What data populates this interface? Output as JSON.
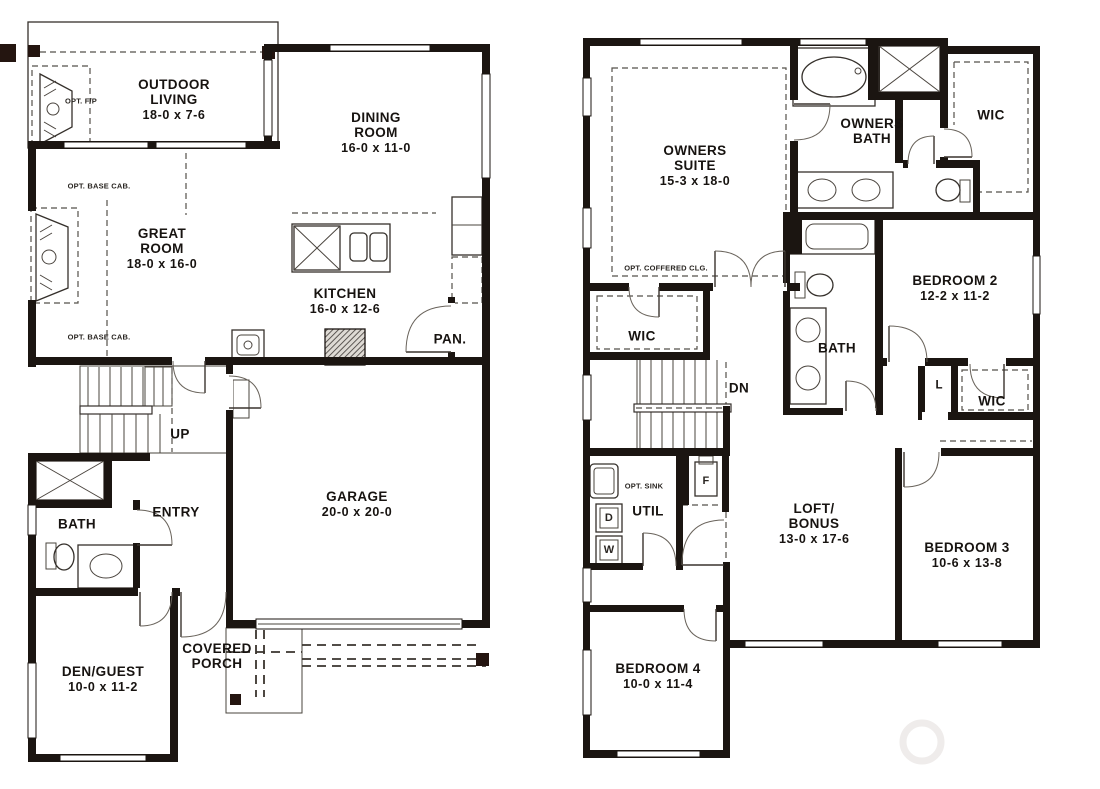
{
  "document": {
    "kind": "architectural floor plan, two levels side by side",
    "ink_color": "#1b1511",
    "background": "#ffffff"
  },
  "floor1": {
    "rooms": {
      "outdoor_living": {
        "name": "OUTDOOR LIVING",
        "dims": "18-0 x 7-6"
      },
      "dining_room": {
        "name": "DINING ROOM",
        "dims": "16-0 x 11-0"
      },
      "great_room": {
        "name": "GREAT ROOM",
        "dims": "18-0 x 16-0"
      },
      "kitchen": {
        "name": "KITCHEN",
        "dims": "16-0 x 12-6"
      },
      "pantry": {
        "name": "PAN."
      },
      "garage": {
        "name": "GARAGE",
        "dims": "20-0 x 20-0"
      },
      "entry": {
        "name": "ENTRY"
      },
      "bath": {
        "name": "BATH"
      },
      "den_guest": {
        "name": "DEN/GUEST",
        "dims": "10-0 x 11-2"
      },
      "covered_porch": {
        "name": "COVERED PORCH"
      },
      "stairs": {
        "name": "UP"
      }
    },
    "annotations": {
      "opt_fireplace": "OPT. F/P",
      "opt_base_cab_upper": "OPT. BASE CAB.",
      "opt_base_cab_lower": "OPT. BASE CAB."
    }
  },
  "floor2": {
    "rooms": {
      "owners_suite": {
        "name": "OWNERS SUITE",
        "dims": "15-3 x 18-0"
      },
      "owners_bath": {
        "name": "OWNERS BATH"
      },
      "wic_top_right": {
        "name": "WIC"
      },
      "wic_left": {
        "name": "WIC"
      },
      "bedroom2": {
        "name": "BEDROOM 2",
        "dims": "12-2 x 11-2"
      },
      "bath": {
        "name": "BATH"
      },
      "linen": {
        "name": "L"
      },
      "wic_bedroom2": {
        "name": "WIC"
      },
      "util": {
        "name": "UTIL"
      },
      "loft_bonus": {
        "name": "LOFT/ BONUS",
        "dims": "13-0 x 17-6"
      },
      "bedroom3": {
        "name": "BEDROOM 3",
        "dims": "10-6 x 13-8"
      },
      "bedroom4": {
        "name": "BEDROOM 4",
        "dims": "10-0 x 11-4"
      },
      "stairs": {
        "name": "DN"
      }
    },
    "annotations": {
      "opt_coffered_clg": "OPT. COFFERED CLG.",
      "opt_sink": "OPT. SINK",
      "dryer": "D",
      "washer": "W",
      "furnace": "F"
    }
  }
}
